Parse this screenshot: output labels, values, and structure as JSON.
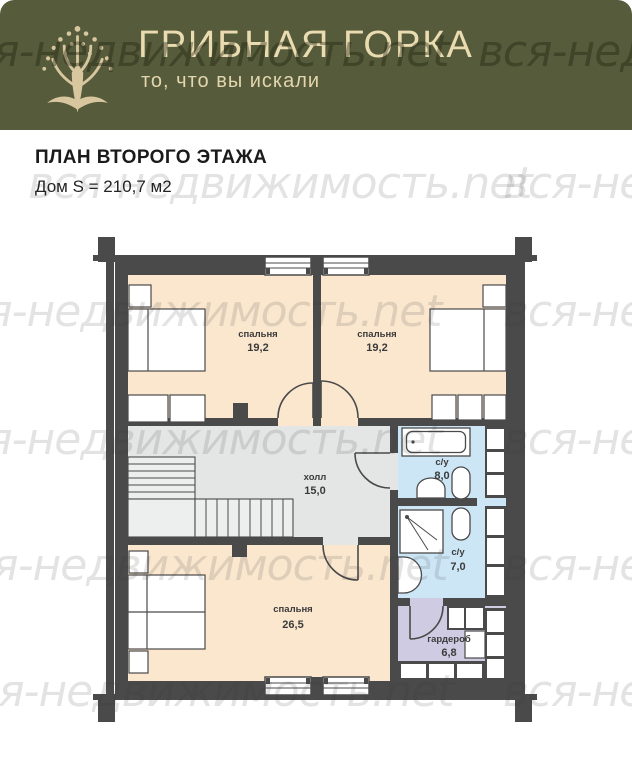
{
  "header": {
    "brand": "ГРИБНАЯ ГОРКА",
    "tagline": "то, что вы искали",
    "bg_color": "#565C3B",
    "text_color": "#EADCB0",
    "logo_color": "#D8C79E"
  },
  "page": {
    "title": "ПЛАН ВТОРОГО ЭТАЖА",
    "subtitle": "Дом S = 210,7 м2"
  },
  "watermark": {
    "text": "вся-недвижимость.net"
  },
  "plan": {
    "floor": "второй этаж",
    "total_area_m2": "210,7",
    "rooms": [
      {
        "name": "спальня",
        "area": "19,2"
      },
      {
        "name": "спальня",
        "area": "19,2"
      },
      {
        "name": "холл",
        "area": "15,0"
      },
      {
        "name": "с/у",
        "area": "8,0"
      },
      {
        "name": "с/у",
        "area": "7,0"
      },
      {
        "name": "спальня",
        "area": "26,5"
      },
      {
        "name": "гардероб",
        "area": "6,8"
      }
    ],
    "colors": {
      "wall": "#4A4A4A",
      "bedroom_floor": "#FAE7CE",
      "hall_floor": "#E4E6E5",
      "bathroom_floor": "#CDE6F6",
      "wardrobe_floor": "#CFCBE2"
    }
  }
}
